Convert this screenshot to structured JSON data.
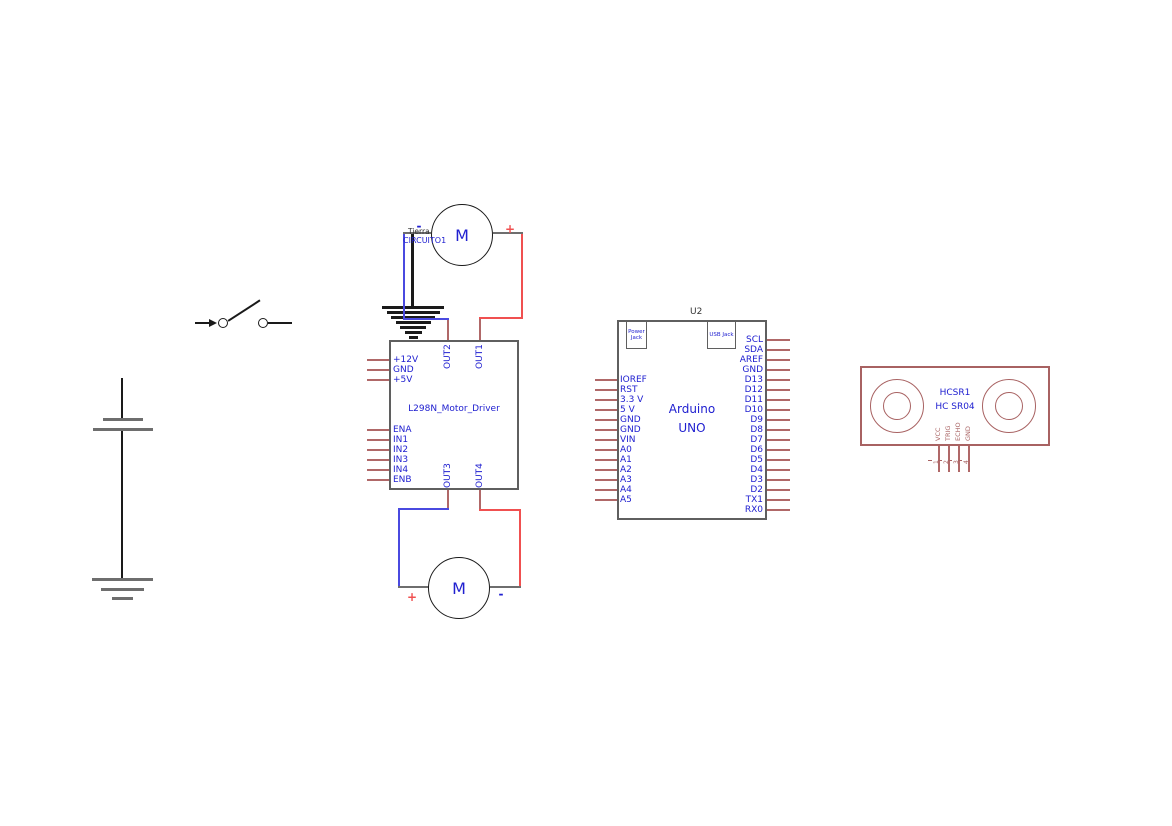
{
  "colors": {
    "wire_red": "#f05050",
    "wire_blue": "#4a4ae0",
    "wire_gray": "#6e6e6e",
    "wire_black": "#1a1a1a",
    "pin_stub": "#b06868",
    "outline_gray": "#5f5f5f",
    "outline_red": "#a86262",
    "text_blue": "#2020d0",
    "text_dark": "#333333"
  },
  "motors": {
    "top": {
      "label": "M",
      "minus": "-",
      "plus": "+",
      "net_line1": "Tierra",
      "net_line2": "CIRCUITO1"
    },
    "bottom": {
      "label": "M",
      "plus": "+",
      "minus": "-"
    }
  },
  "l298n": {
    "title": "L298N_Motor_Driver",
    "left_power_pins": [
      "+12V",
      "GND",
      "+5V"
    ],
    "left_control_pins": [
      "ENA",
      "IN1",
      "IN2",
      "IN3",
      "IN4",
      "ENB"
    ],
    "top_output_pins": [
      "OUT2",
      "OUT1"
    ],
    "bottom_output_pins": [
      "OUT3",
      "OUT4"
    ]
  },
  "arduino": {
    "reference": "U2",
    "title_line1": "Arduino",
    "title_line2": "UNO",
    "power_jack_label": "Power Jack",
    "usb_jack_label": "USB Jack",
    "left_pins": [
      "IOREF",
      "RST",
      "3.3 V",
      "5 V",
      "GND",
      "GND",
      "VIN",
      "A0",
      "A1",
      "A2",
      "A3",
      "A4",
      "A5"
    ],
    "right_pins": [
      "SCL",
      "SDA",
      "AREF",
      "GND",
      "D13",
      "D12",
      "D11",
      "D10",
      "D9",
      "D8",
      "D7",
      "D6",
      "D5",
      "D4",
      "D3",
      "D2",
      "TX1",
      "RX0"
    ]
  },
  "hcsr04": {
    "reference": "HCSR1",
    "name": "HC SR04",
    "pins": [
      {
        "number": "1",
        "label": "VCC"
      },
      {
        "number": "2",
        "label": "TRIG"
      },
      {
        "number": "3",
        "label": "ECHO"
      },
      {
        "number": "4",
        "label": "GND"
      }
    ]
  }
}
